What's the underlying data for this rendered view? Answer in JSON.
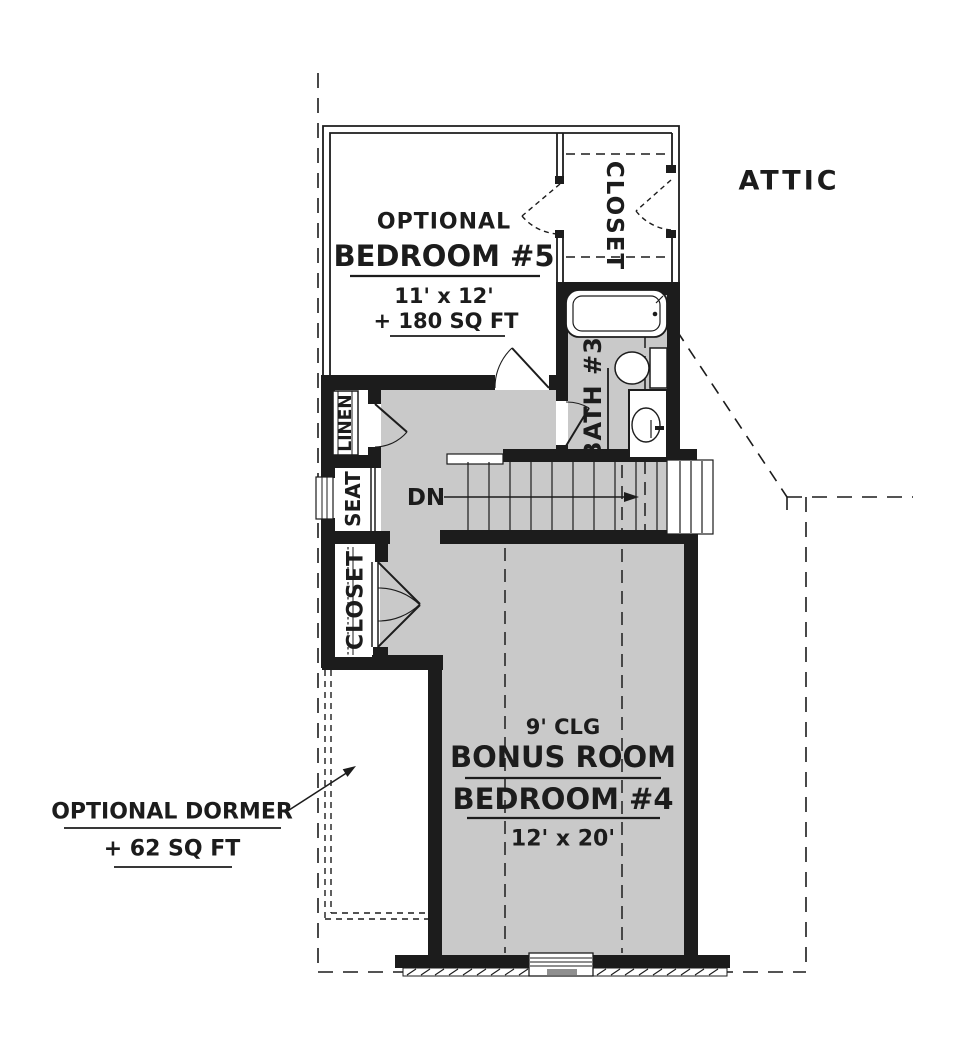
{
  "plan": {
    "title": "Second floor plan with optional bedroom 5, bath 3, bonus room / bedroom 4, optional dormer and attic",
    "labels": {
      "attic": "ATTIC",
      "bedroom5_optional": "OPTIONAL",
      "bedroom5_name": "BEDROOM #5",
      "bedroom5_dims": "11' x 12'",
      "bedroom5_area": "+ 180 SQ FT",
      "closet_top": "CLOSET",
      "bath3": "BATH #3",
      "linen": "LINEN",
      "seat": "SEAT",
      "closet_hall": "CLOSET",
      "stairs_dn": "DN",
      "bonus_ceiling": "9' CLG",
      "bonus_name1": "BONUS ROOM",
      "bonus_name2": "BEDROOM #4",
      "bonus_dims": "12' x 20'",
      "dormer_name": "OPTIONAL DORMER",
      "dormer_area": "+ 62 SQ FT"
    },
    "colors": {
      "wall": "#1c1c1c",
      "floor_gray": "#c9c9c9",
      "background": "#ffffff"
    }
  }
}
